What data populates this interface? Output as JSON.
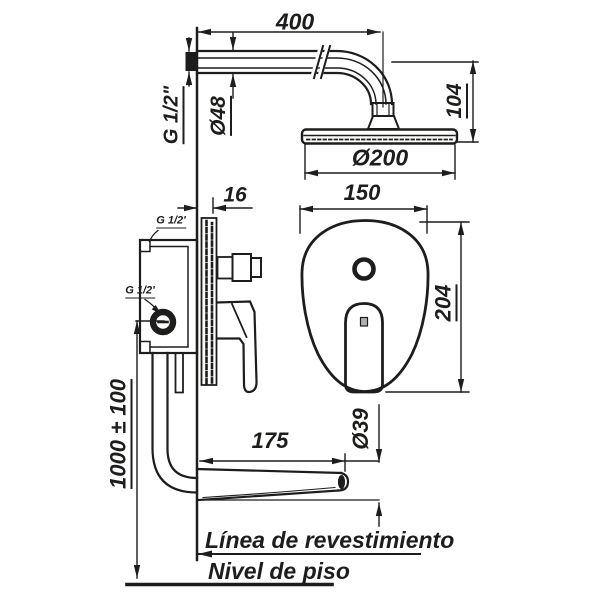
{
  "diagram": {
    "title": "shower-mixer-installation-drawing",
    "line_color": "#1d1d1b",
    "background_color": "#ffffff",
    "labels": {
      "dim_arm_length": "400",
      "thread_arm": "G 1/2\"",
      "dia_flange": "Ø48",
      "dim_head_drop": "104",
      "dia_head": "Ø200",
      "dim_plate_thickness": "16",
      "dim_plate_width": "150",
      "dim_plate_height": "204",
      "thread_valve_top": "G 1/2'",
      "thread_valve_inlet": "G 1/2'",
      "dim_install_height": "1000 ± 100",
      "dim_spout_length": "175",
      "dia_spout": "Ø39",
      "tiling_line": "Línea de revestimiento",
      "floor_line": "Nivel de piso"
    }
  }
}
